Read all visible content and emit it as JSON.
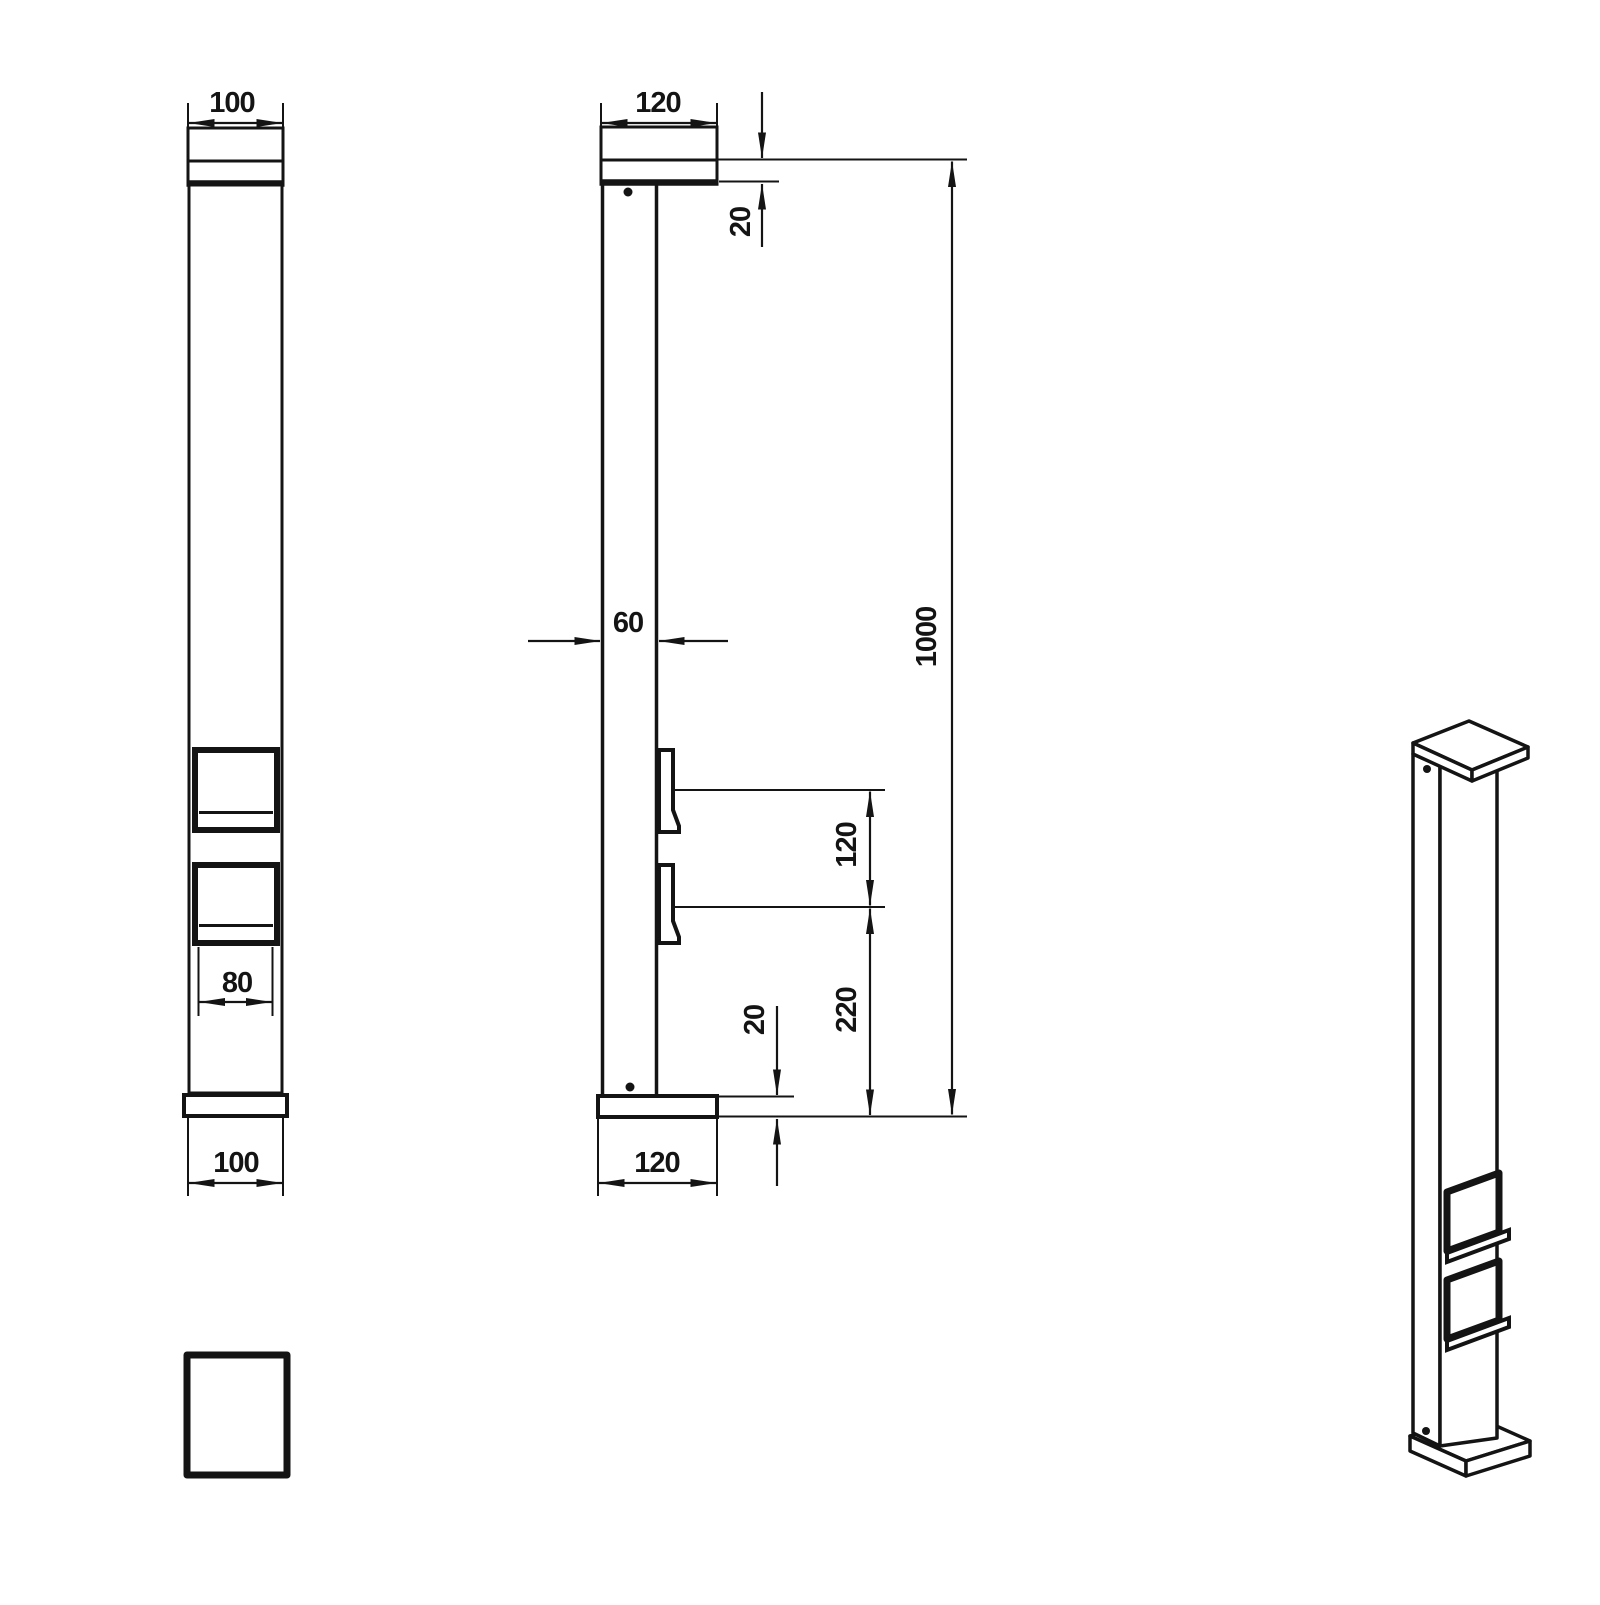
{
  "drawing_type": "technical-orthographic-drawing",
  "subject": "outdoor-socket-pillar",
  "dims": {
    "front_top_width": "100",
    "socket_width": "80",
    "front_bottom_width": "100",
    "side_top_depth": "120",
    "cap_overlap": "20",
    "pole_depth": "60",
    "total_height": "1000",
    "socket_spacing": "120",
    "socket_to_base": "220",
    "base_thickness": "20",
    "side_bottom_depth": "120"
  },
  "colors": {
    "line": "#141414",
    "background": "#ffffff"
  }
}
